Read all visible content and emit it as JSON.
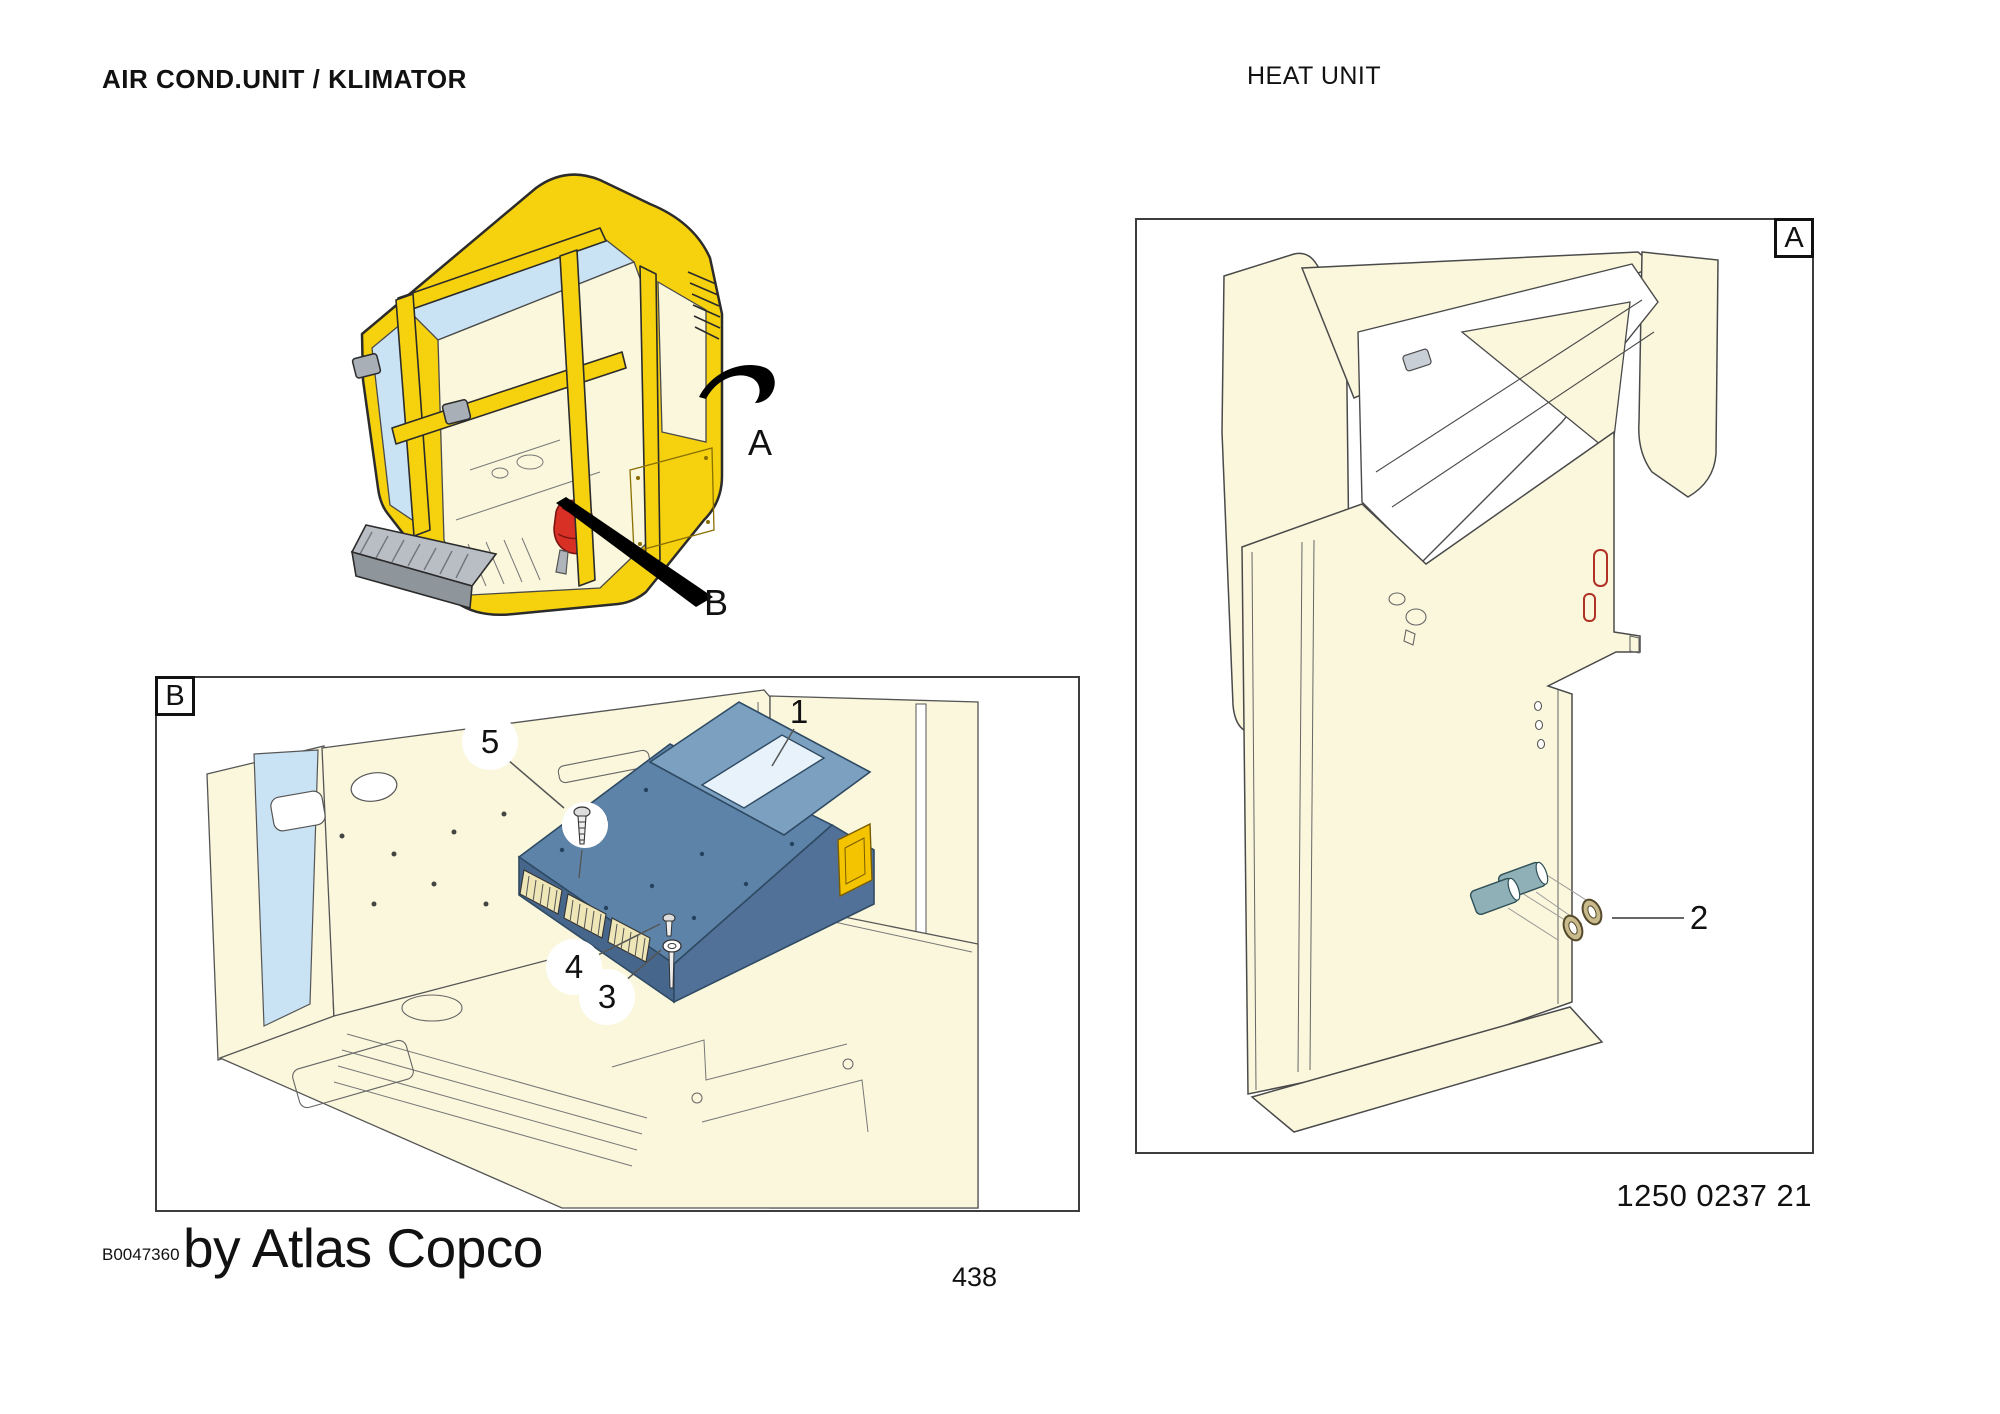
{
  "page": {
    "title_left": "AIR COND.UNIT / KLIMATOR",
    "title_right": "HEAT UNIT",
    "part_number": "1250 0237 21",
    "doc_number": "B0047360",
    "brand_credit": "by Atlas Copco",
    "page_number": "438"
  },
  "overview": {
    "view_a_label": "A",
    "view_b_label": "B"
  },
  "detail_b": {
    "box_label": "B",
    "callouts": [
      {
        "number": "1"
      },
      {
        "number": "5"
      },
      {
        "number": "4"
      },
      {
        "number": "3"
      }
    ]
  },
  "detail_a": {
    "box_label": "A",
    "callouts": [
      {
        "number": "2"
      }
    ]
  },
  "colors": {
    "cab_yellow": "#F5D10E",
    "unit_blue": "#5D83A8",
    "unit_blue_dark": "#46678B",
    "highlight_red": "#D93026",
    "window_blue": "#C9E3F5",
    "body_cream": "#FAF7DC",
    "step_gray": "#B9BEC4",
    "washer_gold": "#C9BA8C",
    "cylinder_teal": "#8FB0B7"
  }
}
